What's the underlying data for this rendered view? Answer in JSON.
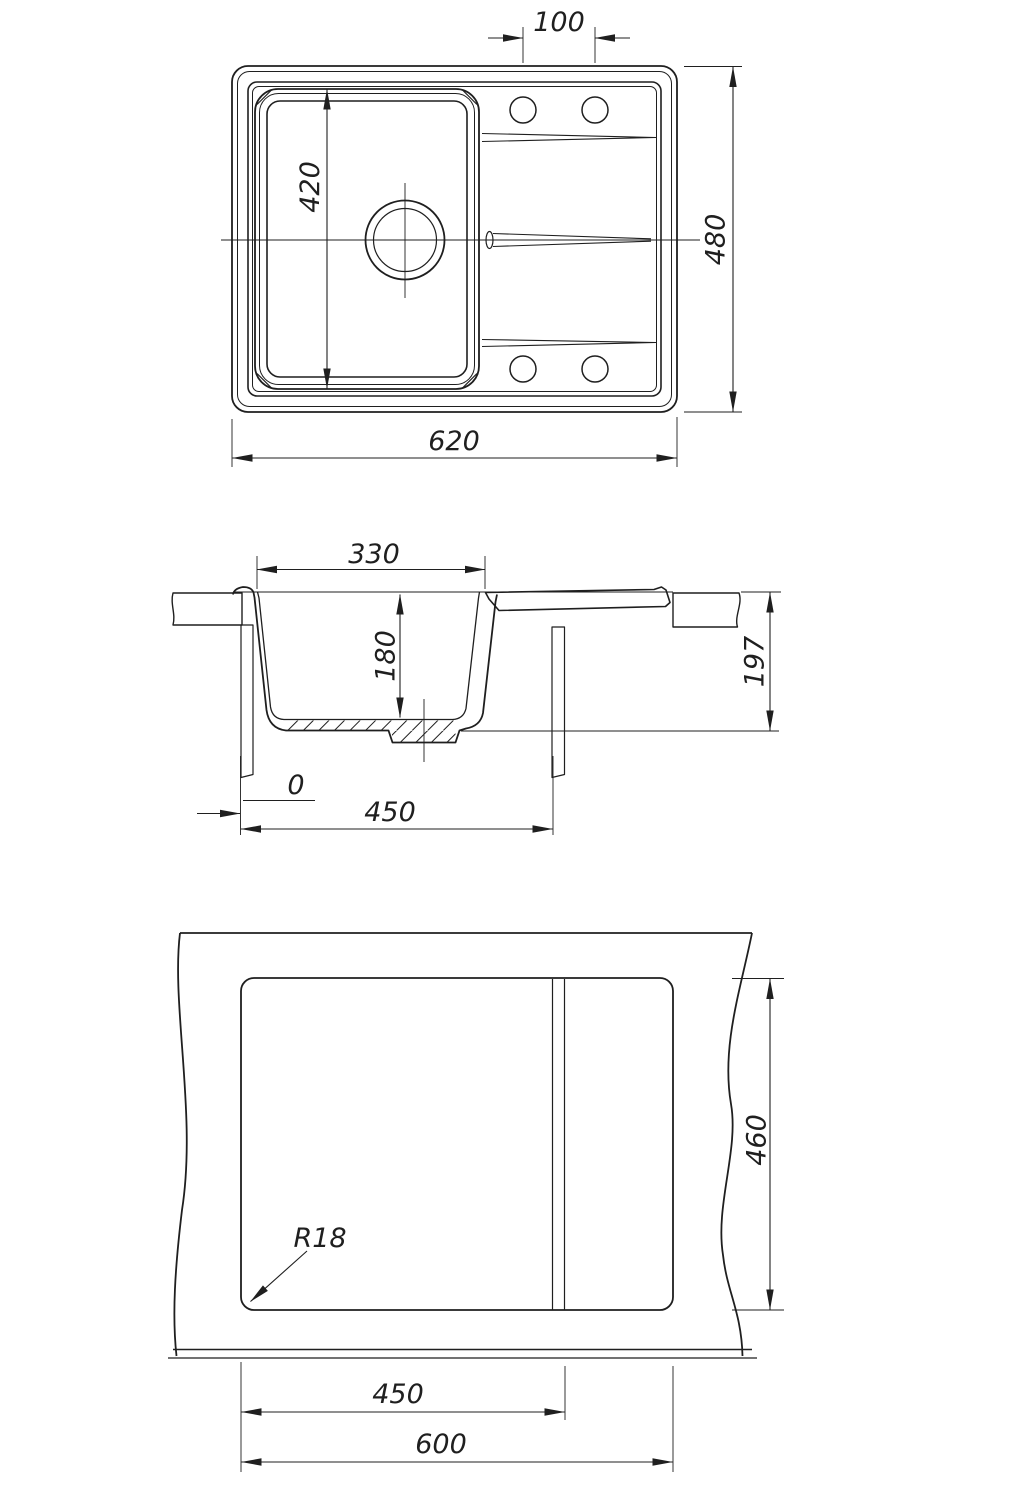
{
  "drawing": {
    "type": "sink-installation-technical-drawing",
    "line_color": "#1f1f1f",
    "background": "#ffffff",
    "labels": {
      "top": {
        "hole_spacing": "100",
        "bowl_length": "420",
        "overall_depth": "480",
        "overall_width": "620"
      },
      "section": {
        "bowl_top_width": "330",
        "bowl_depth": "180",
        "mounting_height": "197",
        "zero_offset": "0",
        "base_width": "450"
      },
      "cutout": {
        "cutout_depth": "460",
        "corner_radius": "R18",
        "partition_offset": "450",
        "cutout_width": "600"
      }
    }
  }
}
